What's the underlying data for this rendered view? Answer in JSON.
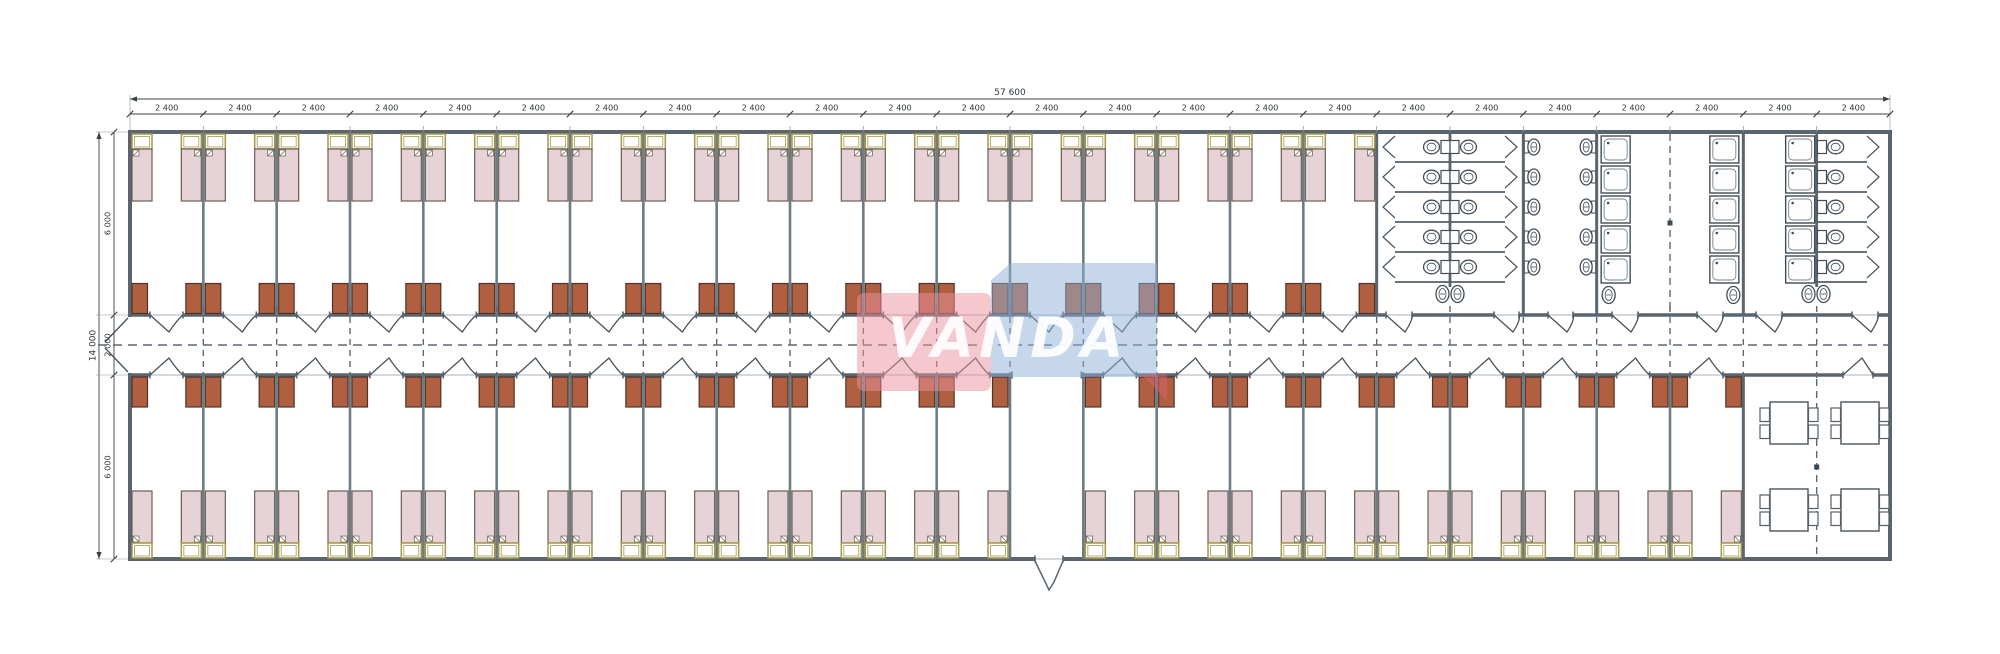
{
  "title": "Modular accommodation building floor plan",
  "watermark": {
    "text": "VANDA",
    "pink": "#e8929d",
    "blue": "#8db0d7",
    "red_tail": "#d5606a"
  },
  "dimensions": {
    "total_width_label": "57 600",
    "module_label": "2 400",
    "module_count": 24,
    "total_height_label": "14 000",
    "height_segment_labels": [
      "6 000",
      "2 000",
      "6 000"
    ]
  },
  "plan": {
    "top_bedroom_modules": 17,
    "bottom_bedroom_modules": 22,
    "vestibule_module_index": 12,
    "beds_per_room": 2,
    "wardrobes_per_room": 2,
    "sanitary": {
      "wc_stall_rows": 5,
      "wc_blocks": 2,
      "sink_rows": 5,
      "shower_rows": 5,
      "shower_columns": 3,
      "corner_basin_pairs": 2,
      "corner_basin_singles": 2
    },
    "dining": {
      "tables": 4,
      "chairs_per_table": 4
    }
  },
  "colors": {
    "wall": "#5a656e",
    "partition": "#6d7b85",
    "dash": "#5d6872",
    "dim_line": "#3c4347",
    "dim_text": "#2f363b",
    "bed_fill": "#e7d2d8",
    "bed_border": "#6a5f52",
    "headboard": "#a3984a",
    "wardrobe_fill": "#b06040",
    "wardrobe_border": "#4e3428",
    "fixture": "#414c55",
    "door": "#4a545c",
    "sill": "#a8b2b8",
    "marker": "#3d4750"
  }
}
